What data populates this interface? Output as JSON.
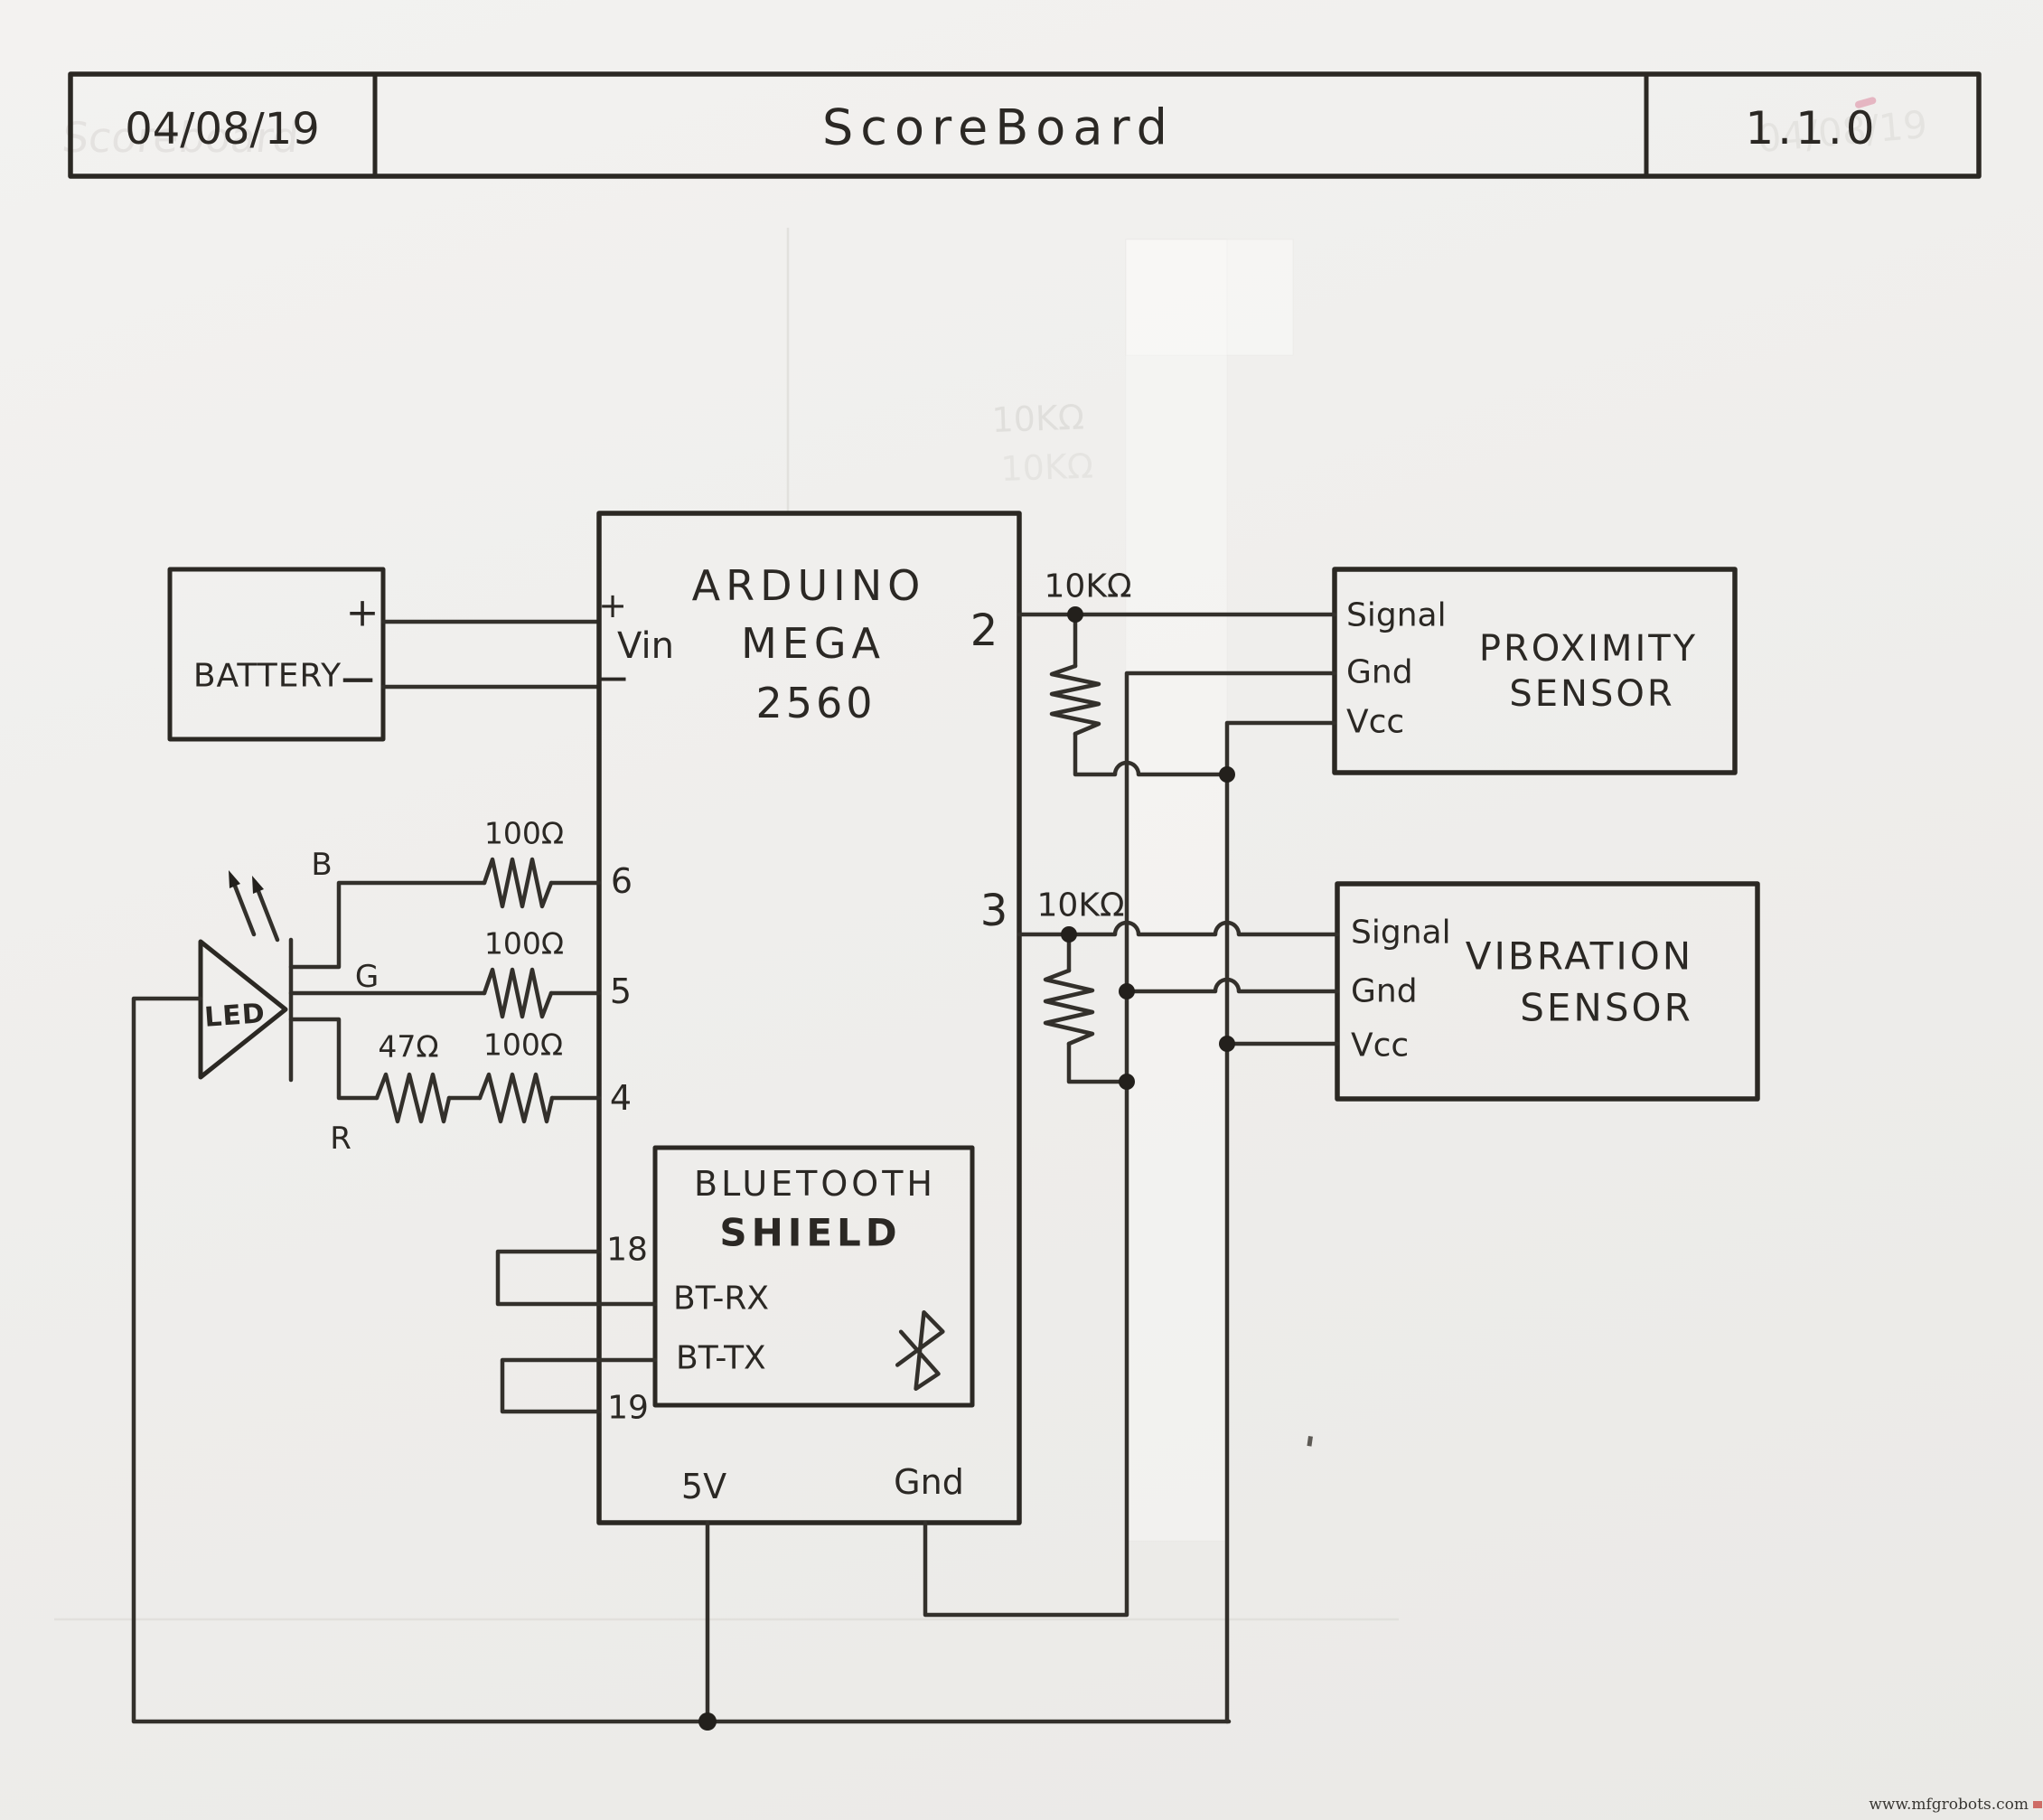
{
  "title_block": {
    "date": "04/08/19",
    "title": "ScoreBoard",
    "version": "1.1.0"
  },
  "battery": {
    "name": "BATTERY",
    "plus": "+",
    "minus": "−"
  },
  "arduino": {
    "line1": "ARDUINO",
    "line2": "MEGA",
    "line3": "2560",
    "pin_vin_plus": "+",
    "pin_vin": "Vin",
    "pin_vin_minus": "−",
    "pin2": "2",
    "pin3": "3",
    "pin6": "6",
    "pin5": "5",
    "pin4": "4",
    "pin18": "18",
    "pin19": "19",
    "pin5v": "5V",
    "pin_gnd": "Gnd"
  },
  "bluetooth": {
    "line1": "BLUETOOTH",
    "line2": "SHIELD",
    "pin_rx": "BT-RX",
    "pin_tx": "BT-TX"
  },
  "proximity": {
    "line1": "PROXIMITY",
    "line2": "SENSOR",
    "pin_signal": "Signal",
    "pin_gnd": "Gnd",
    "pin_vcc": "Vcc"
  },
  "vibration": {
    "line1": "VIBRATION",
    "line2": "SENSOR",
    "pin_signal": "Signal",
    "pin_gnd": "Gnd",
    "pin_vcc": "Vcc"
  },
  "led": {
    "name": "LED",
    "pin_b": "B",
    "pin_g": "G",
    "pin_r": "R"
  },
  "resistors": {
    "pin6": "100Ω",
    "pin5": "100Ω",
    "pin4_a": "47Ω",
    "pin4_b": "100Ω",
    "pin2_pullup": "10KΩ",
    "pin3_pulldown": "10KΩ"
  },
  "artifacts": {
    "ghost_title": "Scoreboard",
    "ghost_resistor1": "10KΩ",
    "ghost_resistor2": "10KΩ",
    "ghost_date": "04/08/19",
    "watermark": "www.mfgrobots.com"
  },
  "colors": {
    "ink": "#2b2824",
    "paper": "#f0efec",
    "watermark_red": "#c9564f",
    "pink_mark": "#e2a3b3"
  }
}
